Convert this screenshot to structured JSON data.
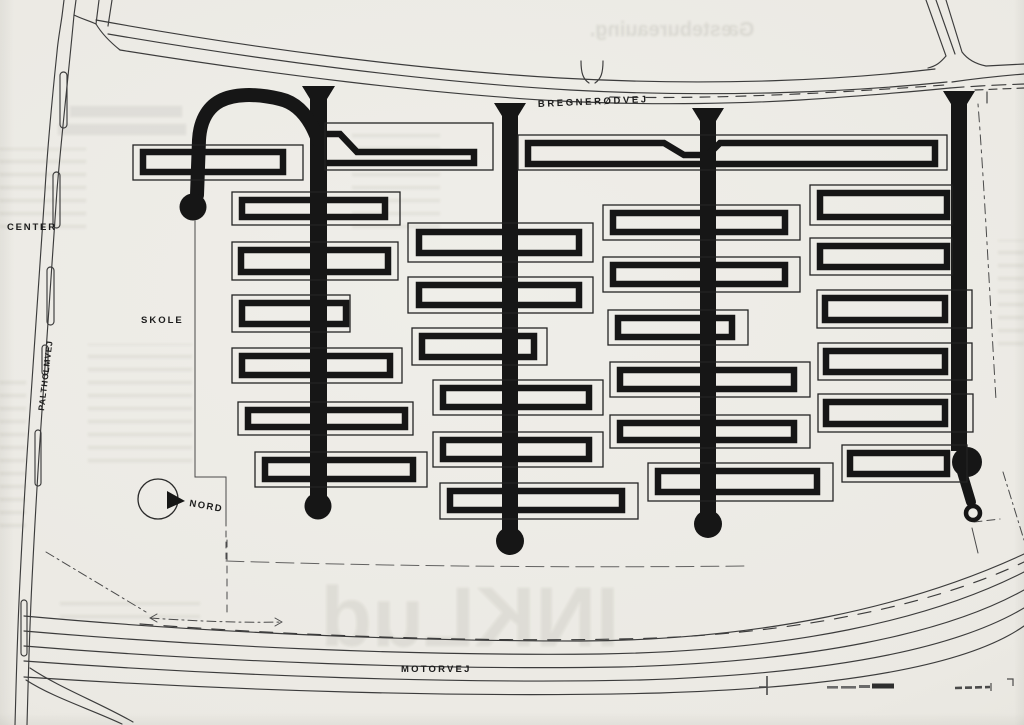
{
  "page": {
    "title": "housing site plan",
    "paper_color": "#ecebe5",
    "ink_color": "#161616",
    "thin_line_color": "#3c3c3c"
  },
  "labels": {
    "bregnerodvej": "BREGNERØDVEJ",
    "center": "CENTER",
    "paltholmvej": "PALTHOLMVEJ",
    "skole": "SKOLE",
    "nord": "NORD",
    "motorvej": "MOTORVEJ"
  },
  "bleedthrough": {
    "top_word": "Gæstebureauing.",
    "bottom_word": "INKLud"
  },
  "plan": {
    "spines": [
      {
        "x": 310,
        "w": 17,
        "top": 99,
        "h": 402,
        "flare": "302,86 335,86 327,99 310,99",
        "circle": [
          318,
          506,
          13.5
        ]
      },
      {
        "x": 502,
        "w": 16,
        "top": 114,
        "h": 416,
        "flare": "494,103 526,103 518,116 502,116",
        "circle": [
          510,
          541,
          14
        ]
      },
      {
        "x": 700,
        "w": 16,
        "top": 119,
        "h": 394,
        "flare": "692,108 724,108 716,121 700,121",
        "circle": [
          708,
          524,
          14
        ]
      },
      {
        "x": 951,
        "w": 16,
        "top": 104,
        "h": 347,
        "flare": "943,91 975,91 967,104 951,104",
        "circle": [
          967,
          462,
          15
        ]
      }
    ],
    "blocks": [
      {
        "id": "s1-t1",
        "o": [
          133,
          145,
          170,
          35
        ],
        "i": [
          143,
          152,
          140,
          20
        ]
      },
      {
        "id": "s1-t2",
        "o": [
          325,
          123,
          168,
          47
        ],
        "ip": "M 327,134 L 340,134 L 357,152 L 474,152 L 474,163 L 327,163"
      },
      {
        "id": "s1-b1",
        "o": [
          232,
          192,
          168,
          33
        ],
        "i": [
          242,
          200,
          143,
          17
        ]
      },
      {
        "id": "s1-b2",
        "o": [
          232,
          242,
          166,
          38
        ],
        "i": [
          241,
          250,
          147,
          22
        ]
      },
      {
        "id": "s1-b3",
        "o": [
          232,
          295,
          118,
          37
        ],
        "i": [
          242,
          303,
          104,
          21
        ]
      },
      {
        "id": "s1-b4",
        "o": [
          232,
          348,
          170,
          35
        ],
        "i": [
          242,
          356,
          148,
          19
        ]
      },
      {
        "id": "s1-b5",
        "o": [
          238,
          402,
          175,
          33
        ],
        "i": [
          248,
          410,
          157,
          17
        ]
      },
      {
        "id": "s1-b6",
        "o": [
          255,
          452,
          172,
          35
        ],
        "i": [
          265,
          460,
          148,
          19
        ]
      },
      {
        "id": "s2-r1",
        "o": [
          408,
          223,
          185,
          39
        ],
        "i": [
          419,
          232,
          160,
          21
        ]
      },
      {
        "id": "s2-r2",
        "o": [
          408,
          277,
          185,
          36
        ],
        "i": [
          419,
          285,
          160,
          20
        ]
      },
      {
        "id": "s2-r3",
        "o": [
          412,
          328,
          135,
          37
        ],
        "i": [
          422,
          336,
          112,
          21
        ]
      },
      {
        "id": "s2-r4",
        "o": [
          433,
          380,
          170,
          35
        ],
        "i": [
          443,
          388,
          146,
          19
        ]
      },
      {
        "id": "s2-r5",
        "o": [
          433,
          432,
          170,
          35
        ],
        "i": [
          443,
          440,
          146,
          19
        ]
      },
      {
        "id": "s2-r6",
        "o": [
          440,
          483,
          198,
          36
        ],
        "i": [
          450,
          491,
          172,
          19
        ]
      },
      {
        "id": "s3-t3",
        "o": [
          518,
          135,
          429,
          35
        ],
        "ip": "M 528,143 L 664,143 L 684,155 L 708,155 L 720,143 L 935,143 L 935,164 L 528,164 Z"
      },
      {
        "id": "s3-s1",
        "o": [
          603,
          205,
          197,
          35
        ],
        "i": [
          613,
          213,
          172,
          19
        ]
      },
      {
        "id": "s3-s2",
        "o": [
          603,
          257,
          197,
          35
        ],
        "i": [
          613,
          265,
          172,
          19
        ]
      },
      {
        "id": "s3-s3",
        "o": [
          608,
          310,
          140,
          35
        ],
        "i": [
          618,
          318,
          114,
          19
        ]
      },
      {
        "id": "s3-s4",
        "o": [
          610,
          362,
          200,
          35
        ],
        "i": [
          620,
          370,
          174,
          19
        ]
      },
      {
        "id": "s3-s5",
        "o": [
          610,
          415,
          200,
          33
        ],
        "i": [
          620,
          423,
          174,
          17
        ]
      },
      {
        "id": "s3-s6",
        "o": [
          648,
          463,
          185,
          38
        ],
        "i": [
          658,
          471,
          159,
          21
        ]
      },
      {
        "id": "s4-p1",
        "o": [
          810,
          185,
          142,
          40
        ],
        "i": [
          820,
          193,
          127,
          24
        ]
      },
      {
        "id": "s4-p2",
        "o": [
          810,
          238,
          142,
          37
        ],
        "i": [
          820,
          246,
          127,
          21
        ]
      },
      {
        "id": "s4-p3",
        "o": [
          817,
          290,
          155,
          38
        ],
        "i": [
          825,
          298,
          120,
          22
        ]
      },
      {
        "id": "s4-p4",
        "o": [
          818,
          343,
          154,
          37
        ],
        "i": [
          826,
          351,
          119,
          21
        ]
      },
      {
        "id": "s4-p5",
        "o": [
          818,
          394,
          155,
          38
        ],
        "i": [
          826,
          402,
          119,
          22
        ]
      },
      {
        "id": "s4-p6",
        "o": [
          842,
          445,
          125,
          37
        ],
        "i": [
          850,
          453,
          97,
          21
        ]
      }
    ]
  }
}
